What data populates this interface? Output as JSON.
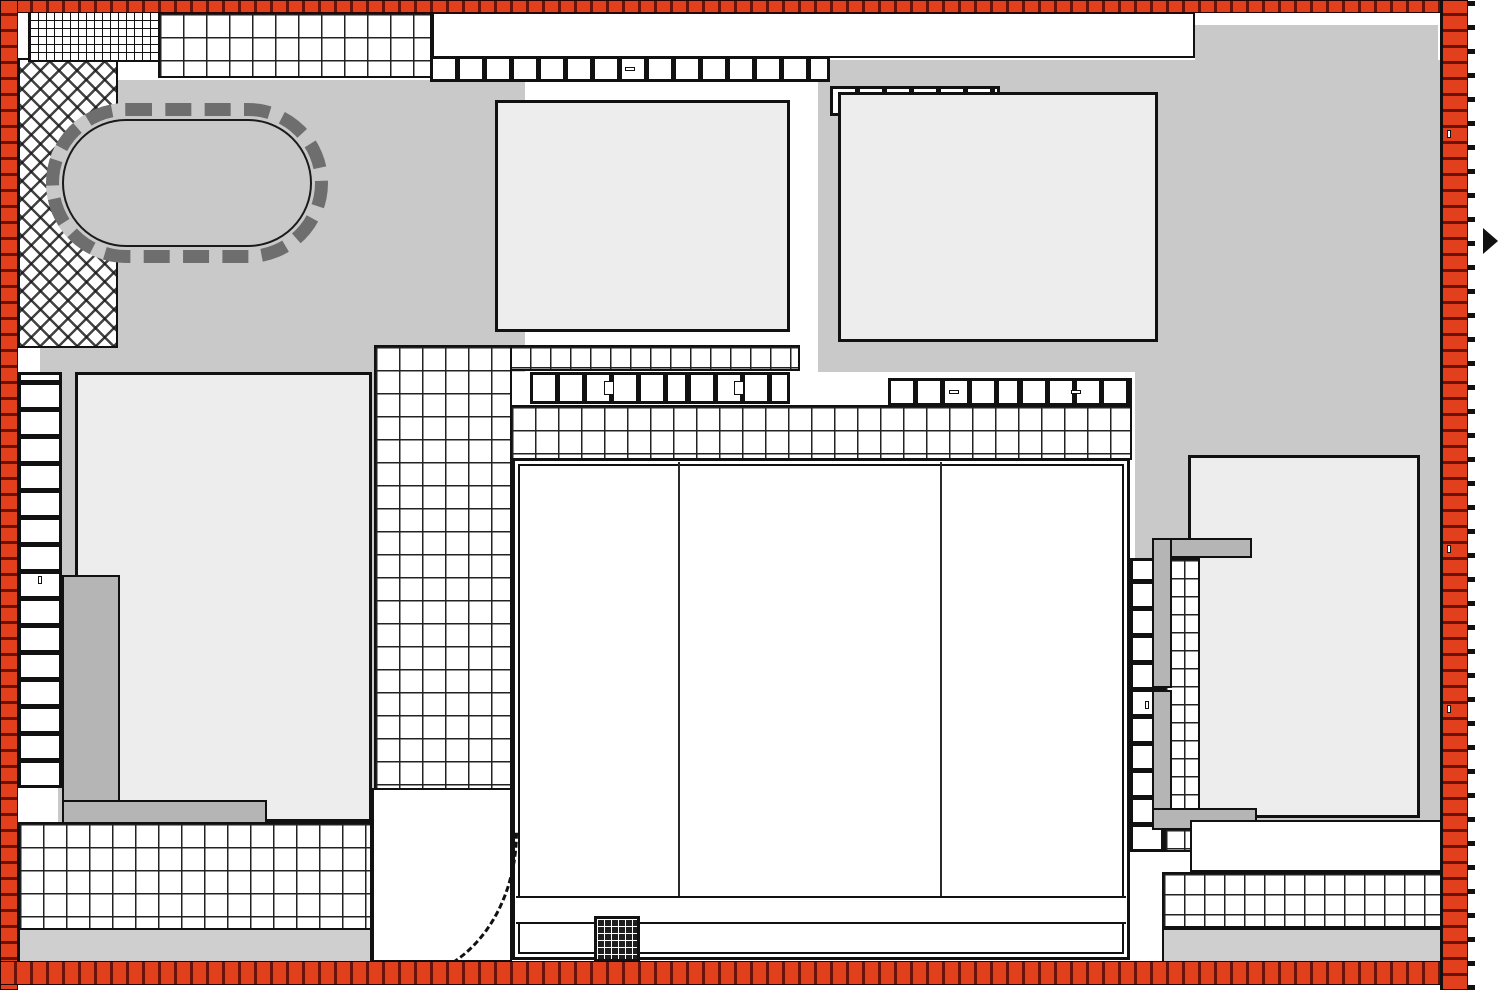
{
  "property_limit": "LIMITE DE PROPRIETE",
  "halls": {
    "ella": {
      "name": "HALL ELLA",
      "levels": "RDC BAS+RDC HAUT+5"
    },
    "duke": {
      "name": "HALL DUKE",
      "levels": "RDC BAS+RDC HAUT+5"
    }
  },
  "garden_north": {
    "line1": "JARDIN NON ACCESSIBLE",
    "line2": "DU RDC BAS"
  },
  "garden_central": {
    "line1": "JARDIN COMMUN",
    "line2": "NON ACCESSIBLE",
    "line3": "DU RDC BAS"
  },
  "technical_terrace": {
    "line1": "TERRASSE TECHNIQUE",
    "line2": "INACCESSIBLE"
  },
  "terraces": {
    "top_left": "TERRASSE DU RDCB+RDCH+5",
    "mid": "TERRASSE DU RDCB+RDCH+5",
    "rdc_haut": "TERRASSE DU RDC HAUT",
    "bottom_left": "TERRASSE DU RDCB+RDCH+4",
    "bottom_right": "TERRASSE DU RDCB+RDCH+5",
    "non_accessible_left": {
      "line1": "TERRASSE NON ACCESSIBLE",
      "line2": "DU RDCB+RDCH+4"
    },
    "non_accessible_right": {
      "line1": "TERRASSE NON ACCESSIBLE",
      "line2": "DU RDCB+RDCH+5"
    }
  },
  "balconies": {
    "top": "BALCON DU RDCB+RDCH+4",
    "inner_top_1": "BALCON DU",
    "inner_top_2": "RDCB+RDCH+4",
    "b5_1": "BALCON DU",
    "b5_2": "RDCB+RDCH+5",
    "b1_1": "BALCON DU",
    "b1_2": "RDCB+RDCH+1",
    "b4_1": "BALCON DU",
    "b4_2": "RDCB+RDCH+4",
    "r4": "RDCB+RDCH+4",
    "r3": "RDCB+RDCH+3",
    "left_edge": "BALCON DU RDCB+RDCH+5",
    "right_mid": "BALCON DU RDCB+RDCH+5",
    "edge_top": "BALCON DU RDCB+RDCH+4",
    "edge_mid": "BALCON DU RDCB+RDCH+5",
    "edge_low": "BALCON DU RDCB+RDCH+5"
  },
  "parking": {
    "line1": "RAMPE",
    "line2": "PARKING"
  },
  "colors": {
    "limit_red": "#e2401c",
    "building_gray": "#c9c9c9",
    "terrace_gray": "#ededed",
    "ink": "#1d2130"
  }
}
